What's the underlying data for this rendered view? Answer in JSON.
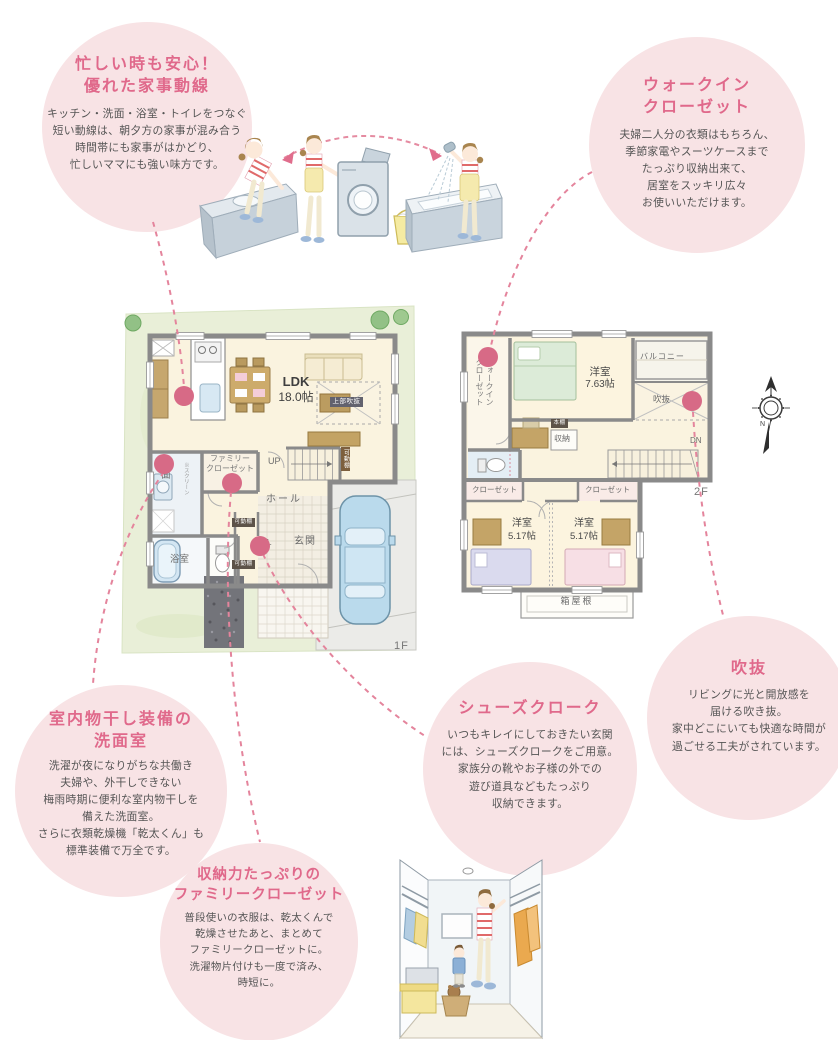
{
  "colors": {
    "bubble_bg": "#f8e3e5",
    "title_pink": "#e0698b",
    "connector_pink": "#e4849c",
    "marker_pink": "#d76a86",
    "lawn_green": "#e9efd8",
    "wall_gray": "#8a8a8a",
    "floor_cream": "#faf3df"
  },
  "bubbles": {
    "kaji": {
      "title1": "忙しい時も安心！",
      "title2": "優れた家事動線",
      "lines": [
        "キッチン・洗面・浴室・トイレをつなぐ",
        "短い動線は、朝夕方の家事が混み合う",
        "時間帯にも家事がはかどり、",
        "忙しいママにも強い味方です。"
      ]
    },
    "wic": {
      "title1": "ウォークイン",
      "title2": "クローゼット",
      "lines": [
        "夫婦二人分の衣類はもちろん、",
        "季節家電やスーツケースまで",
        "たっぷり収納出来て、",
        "居室をスッキリ広々",
        "お使いいただけます。"
      ]
    },
    "monohoshi": {
      "title1": "室内物干し装備の",
      "title2": "洗面室",
      "lines": [
        "洗濯が夜になりがちな共働き",
        "夫婦や、外干しできない",
        "梅雨時期に便利な室内物干しを",
        "備えた洗面室。",
        "さらに衣類乾燥機「乾太くん」も",
        "標準装備で万全です。"
      ]
    },
    "famiclo": {
      "title1": "収納力たっぷりの",
      "title2": "ファミリークローゼット",
      "lines": [
        "普段使いの衣服は、乾太くんで",
        "乾燥させたあと、まとめて",
        "ファミリークローゼットに。",
        "洗濯物片付けも一度で済み、",
        "時短に。"
      ]
    },
    "shoes": {
      "title1": "シューズクローク",
      "lines": [
        "いつもキレイにしておきたい玄関",
        "には、シューズクロークをご用意。",
        "家族分の靴やお子様の外での",
        "遊び道具などもたっぷり",
        "収納できます。"
      ]
    },
    "fukinuke": {
      "title1": "吹抜",
      "lines": [
        "リビングに光と開放感を",
        "届ける吹き抜。",
        "家中どこにいても快適な時間が",
        "過ごせる工夫がされています。"
      ]
    }
  },
  "plan1f": {
    "tag": "1F",
    "ldk": "LDK",
    "ldk_size": "18.0帖",
    "joubu_fukinuke": "上部吹抜",
    "up": "UP",
    "kadoudana": "可動棚",
    "senmen": "洗面",
    "screen_note": "※スクリーン",
    "yokushitsu": "浴室",
    "famiclo1": "ファミリー",
    "famiclo2": "クローゼット",
    "hall": "ホール",
    "scl": "SCL",
    "genkan": "玄関"
  },
  "plan2f": {
    "tag": "2F",
    "wic1": "ウォークイン",
    "wic2": "クローゼット",
    "yoshitsu": "洋室",
    "yoshitsu1_size": "7.63帖",
    "balcony": "バルコニー",
    "fukinuke": "吹抜",
    "shunou": "収納",
    "hondana": "本棚",
    "dn": "DN",
    "closet": "クローゼット",
    "yoshitsu_small_size": "5.17帖",
    "hakoyane": "箱屋根"
  },
  "compass": {
    "n": "N"
  }
}
